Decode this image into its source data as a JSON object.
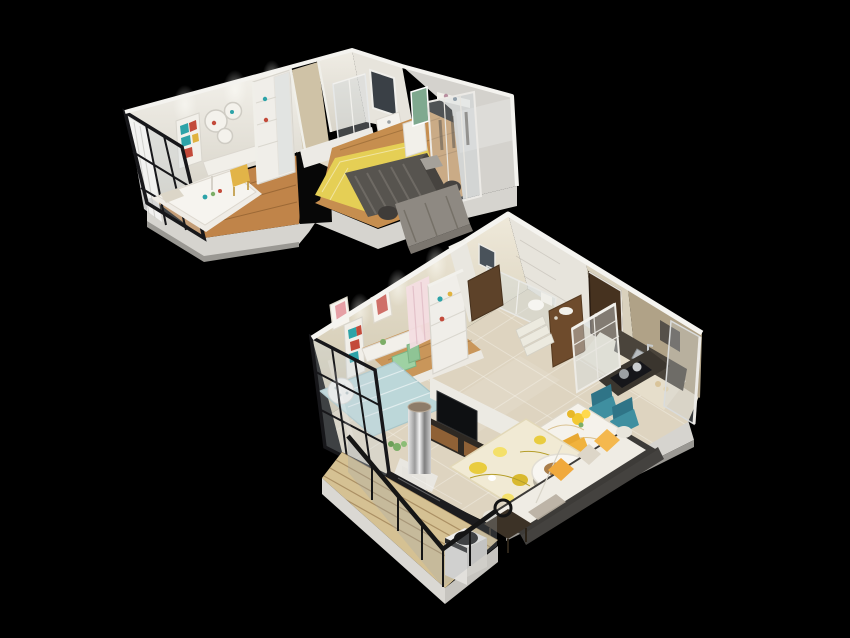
{
  "scene": {
    "type": "3d-floorplan-render",
    "description": "Isometric dollhouse cutaway render of a compact two-level apartment floating on a black background. Upper level: study bedroom with window wall, bathroom, master bedroom with glass wardrobe. Lower level: study nook, living room, dining area, kitchen, entry, bathroom and a wood-deck balcony with washing machine.",
    "background": "#000000"
  },
  "colors": {
    "background": "#000000",
    "plinth_top": "#d6d4cf",
    "plinth_side": "#b5b3ae",
    "wall_white": "#eceae5",
    "wall_cream": "#d9d1bd",
    "wall_tan": "#b0a287",
    "wall_marble": "#e7e4dc",
    "floor_wood": "#c08449",
    "floor_wood_light": "#c9965a",
    "floor_tile": "#ded4c0",
    "floor_tile_light": "#e6decb",
    "deck_wood": "#d5c193",
    "frame_black": "#17171a",
    "glass_pane": "rgba(205,215,222,0.32)",
    "rug_yellow": "#e5cf55",
    "rug_floral_base": "#f1ead4",
    "bed_dark": "#57544f",
    "bed_blue": "#bcd7d9",
    "sofa_gray": "#8e8982",
    "sofa_white": "#efece4",
    "sofa_frame": "#3d3b38",
    "pillow_yellow": "#f0a93c",
    "chair_teal": "#3f8fa0",
    "chair_mint": "#9ed1a3",
    "chair_yellow": "#f0b23c",
    "door_brown": "#46321f",
    "cabinet_dark": "#2e2923",
    "cabinet_wood": "#8f6136",
    "counter_dark": "#4a443b",
    "mirror_green": "#7fa98f",
    "book_teal": "#2da3a8",
    "book_red": "#c34a3a",
    "stool_yellow": "#e2b448",
    "plant_green": "#7cae67"
  },
  "units": [
    {
      "id": "upper-unit",
      "label": "Upper level",
      "rooms": [
        {
          "name": "study-bedroom",
          "items": [
            "black-framed-window-wall",
            "white-curtain",
            "single-bed-white-bedding",
            "white-desk",
            "yellow-stool",
            "wall-bookshelf-colorful-books",
            "round-wall-shelves",
            "white-display-wardrobe"
          ]
        },
        {
          "name": "bathroom",
          "items": [
            "marble-walls",
            "dark-window",
            "glass-shower",
            "white-sink-counter",
            "white-half-wall"
          ]
        },
        {
          "name": "master-bedroom",
          "items": [
            "wood-floor",
            "yellow-rug",
            "dark-gray-double-bed",
            "gray-sofa",
            "round-side-drums",
            "white-vanity-desk",
            "green-framed-mirror",
            "white-wall-shelf",
            "glass-front-wardrobe"
          ]
        }
      ]
    },
    {
      "id": "lower-unit",
      "label": "Main level",
      "rooms": [
        {
          "name": "study-nook",
          "items": [
            "black-framed-window-wall",
            "two-framed-posters",
            "wall-bookshelf",
            "white-desk",
            "mint-green-chair",
            "wood-platform",
            "light-blue-daybed",
            "polka-dot-beanbag",
            "white-shelving-wardrobe",
            "pink-curtain"
          ]
        },
        {
          "name": "living-room",
          "items": [
            "beige-tile-floor",
            "white-media-panel",
            "flat-screen-tv",
            "walnut-tv-cabinet",
            "mirror-steel-column",
            "potted-plant",
            "floral-yellow-rug",
            "round-white-coffee-table",
            "white-sofa-dark-frame",
            "yellow-throw-pillows",
            "dark-side-table",
            "black-ring-floor-lamp"
          ]
        },
        {
          "name": "dining-area",
          "items": [
            "white-marble-dining-table",
            "yellow-flower-bouquet",
            "two-teal-chairs",
            "yellow-chair"
          ]
        },
        {
          "name": "kitchen",
          "items": [
            "white-framed-glass-partition",
            "tan-walls",
            "dark-counter-stainless-sink",
            "gas-cooktop-with-pots",
            "frosted-glass-exterior-wall"
          ]
        },
        {
          "name": "entry",
          "items": [
            "dark-brown-entry-door",
            "walnut-vanity-sideboard",
            "shoe-cabinet",
            "white-steps"
          ]
        },
        {
          "name": "bathroom",
          "items": [
            "marble-walls",
            "dark-mirror",
            "glass-shower-partition",
            "white-toilet"
          ]
        },
        {
          "name": "balcony",
          "items": [
            "glass-railing-black-top-rail",
            "wood-plank-deck",
            "black-marble-ledge",
            "white-washing-machine-black-lid",
            "white-service-column"
          ]
        }
      ]
    }
  ]
}
